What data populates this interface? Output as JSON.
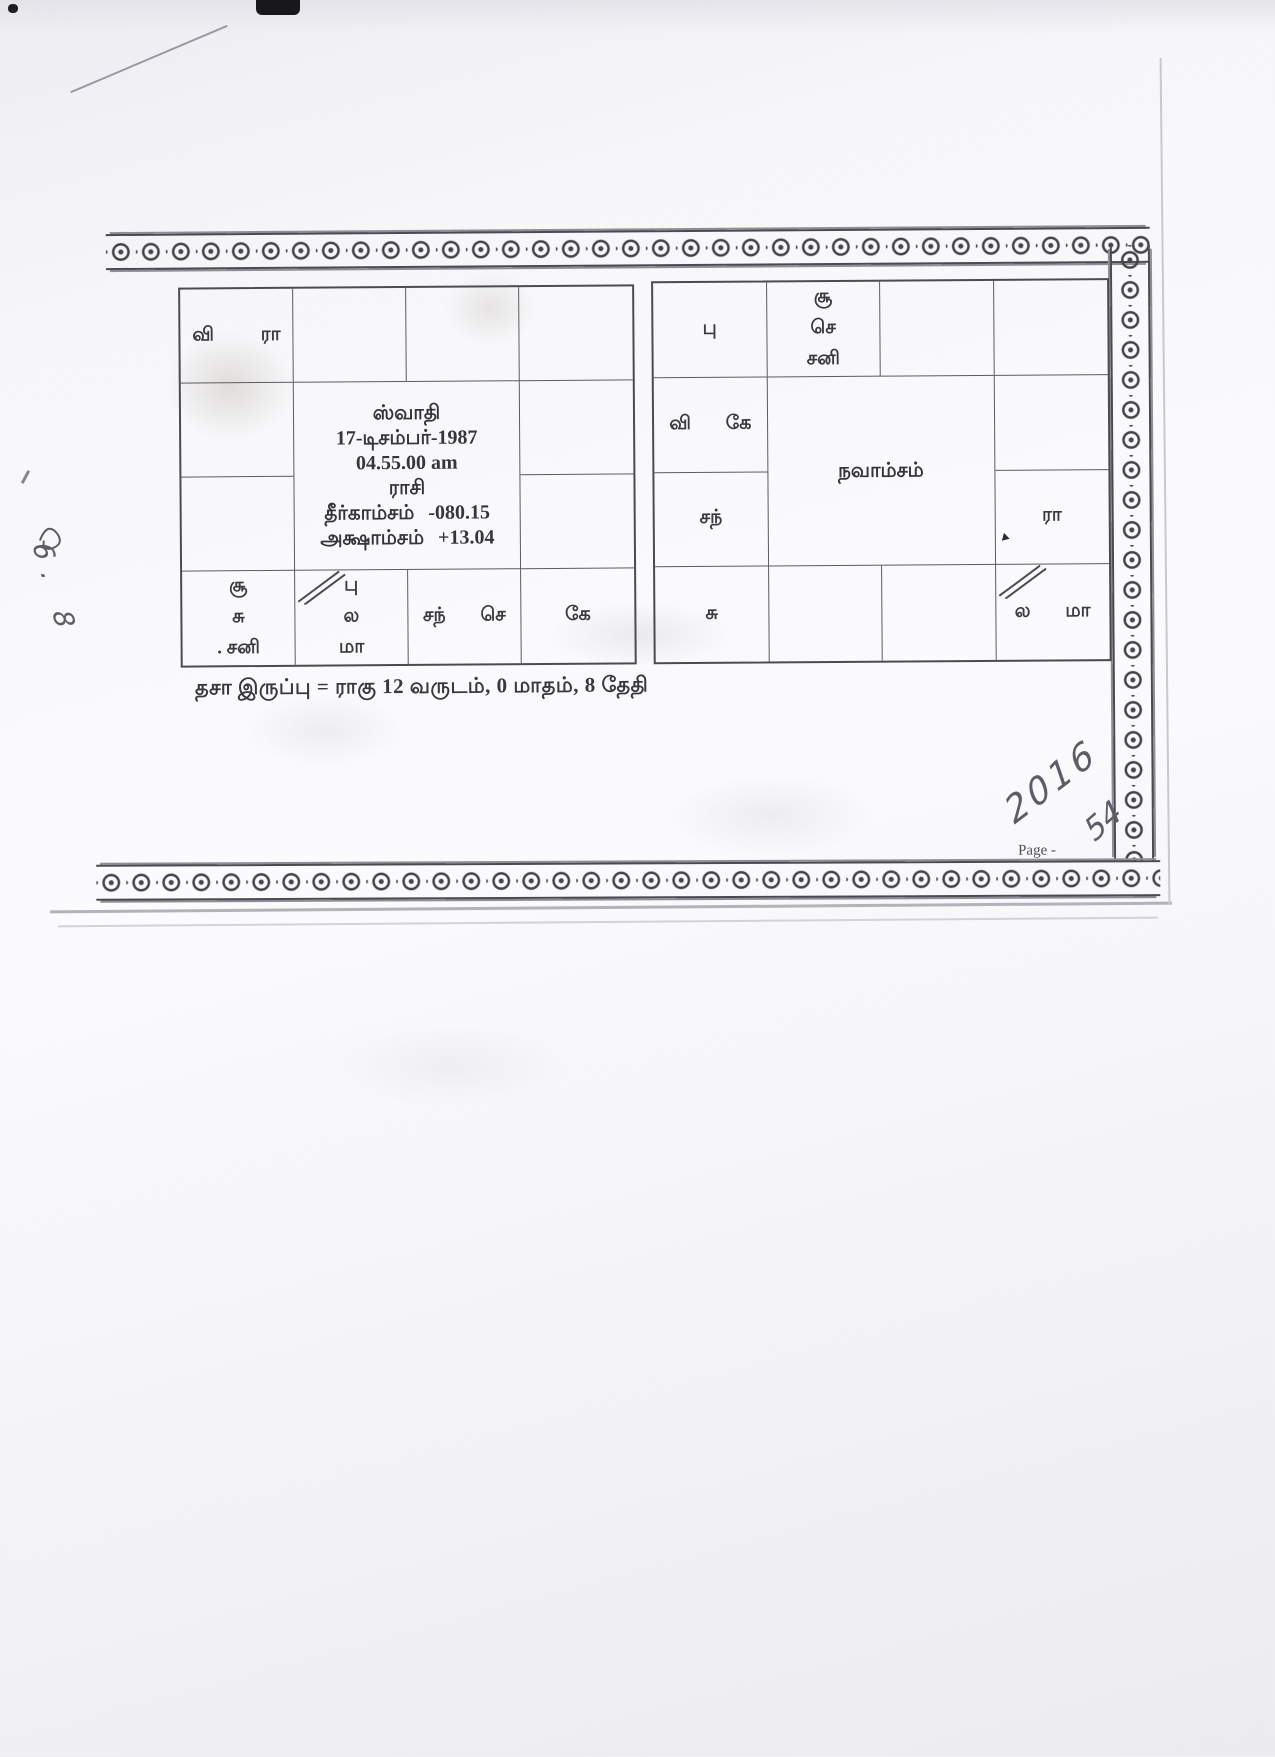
{
  "rasi": {
    "center": {
      "nakshatra": "ஸ்வாதி",
      "date": "17-டிசம்பர்-1987",
      "time": "04.55.00 am",
      "title": "ராசி",
      "longitude_label": "தீர்காம்சம்",
      "longitude_value": "-080.15",
      "latitude_label": "அக்ஷாம்சம்",
      "latitude_value": "+13.04"
    },
    "cells": {
      "r1c1": {
        "lines": [
          "வி ரா"
        ]
      },
      "r4c1": {
        "lines": [
          "சூ",
          "சு",
          ". சனி"
        ]
      },
      "r4c2": {
        "lines": [
          "பு",
          "ல",
          "மா"
        ]
      },
      "r4c3": {
        "lines": [
          "சந் செ"
        ]
      },
      "r4c4": {
        "lines": [
          "கே"
        ]
      }
    }
  },
  "navamsa": {
    "title": "நவாம்சம்",
    "cells": {
      "r1c1": {
        "lines": [
          "பு"
        ]
      },
      "r1c2": {
        "lines": [
          "சூ",
          "செ",
          "சனி"
        ]
      },
      "r2c1": {
        "lines": [
          "வி கே"
        ]
      },
      "r3c1": {
        "lines": [
          "சந்"
        ]
      },
      "r3c4": {
        "lines": [
          "ரா"
        ]
      },
      "r4c1": {
        "lines": [
          "சு"
        ]
      },
      "r4c4": {
        "lines": [
          "ல மா"
        ]
      }
    }
  },
  "footer": {
    "dasa_line": "தசா இருப்பு = ராகு 12 வருடம், 0 மாதம், 8 தேதி",
    "page_label": "Page -"
  },
  "handwriting": {
    "year": "2016",
    "page_number": "54",
    "margin_note": "6. 8"
  }
}
